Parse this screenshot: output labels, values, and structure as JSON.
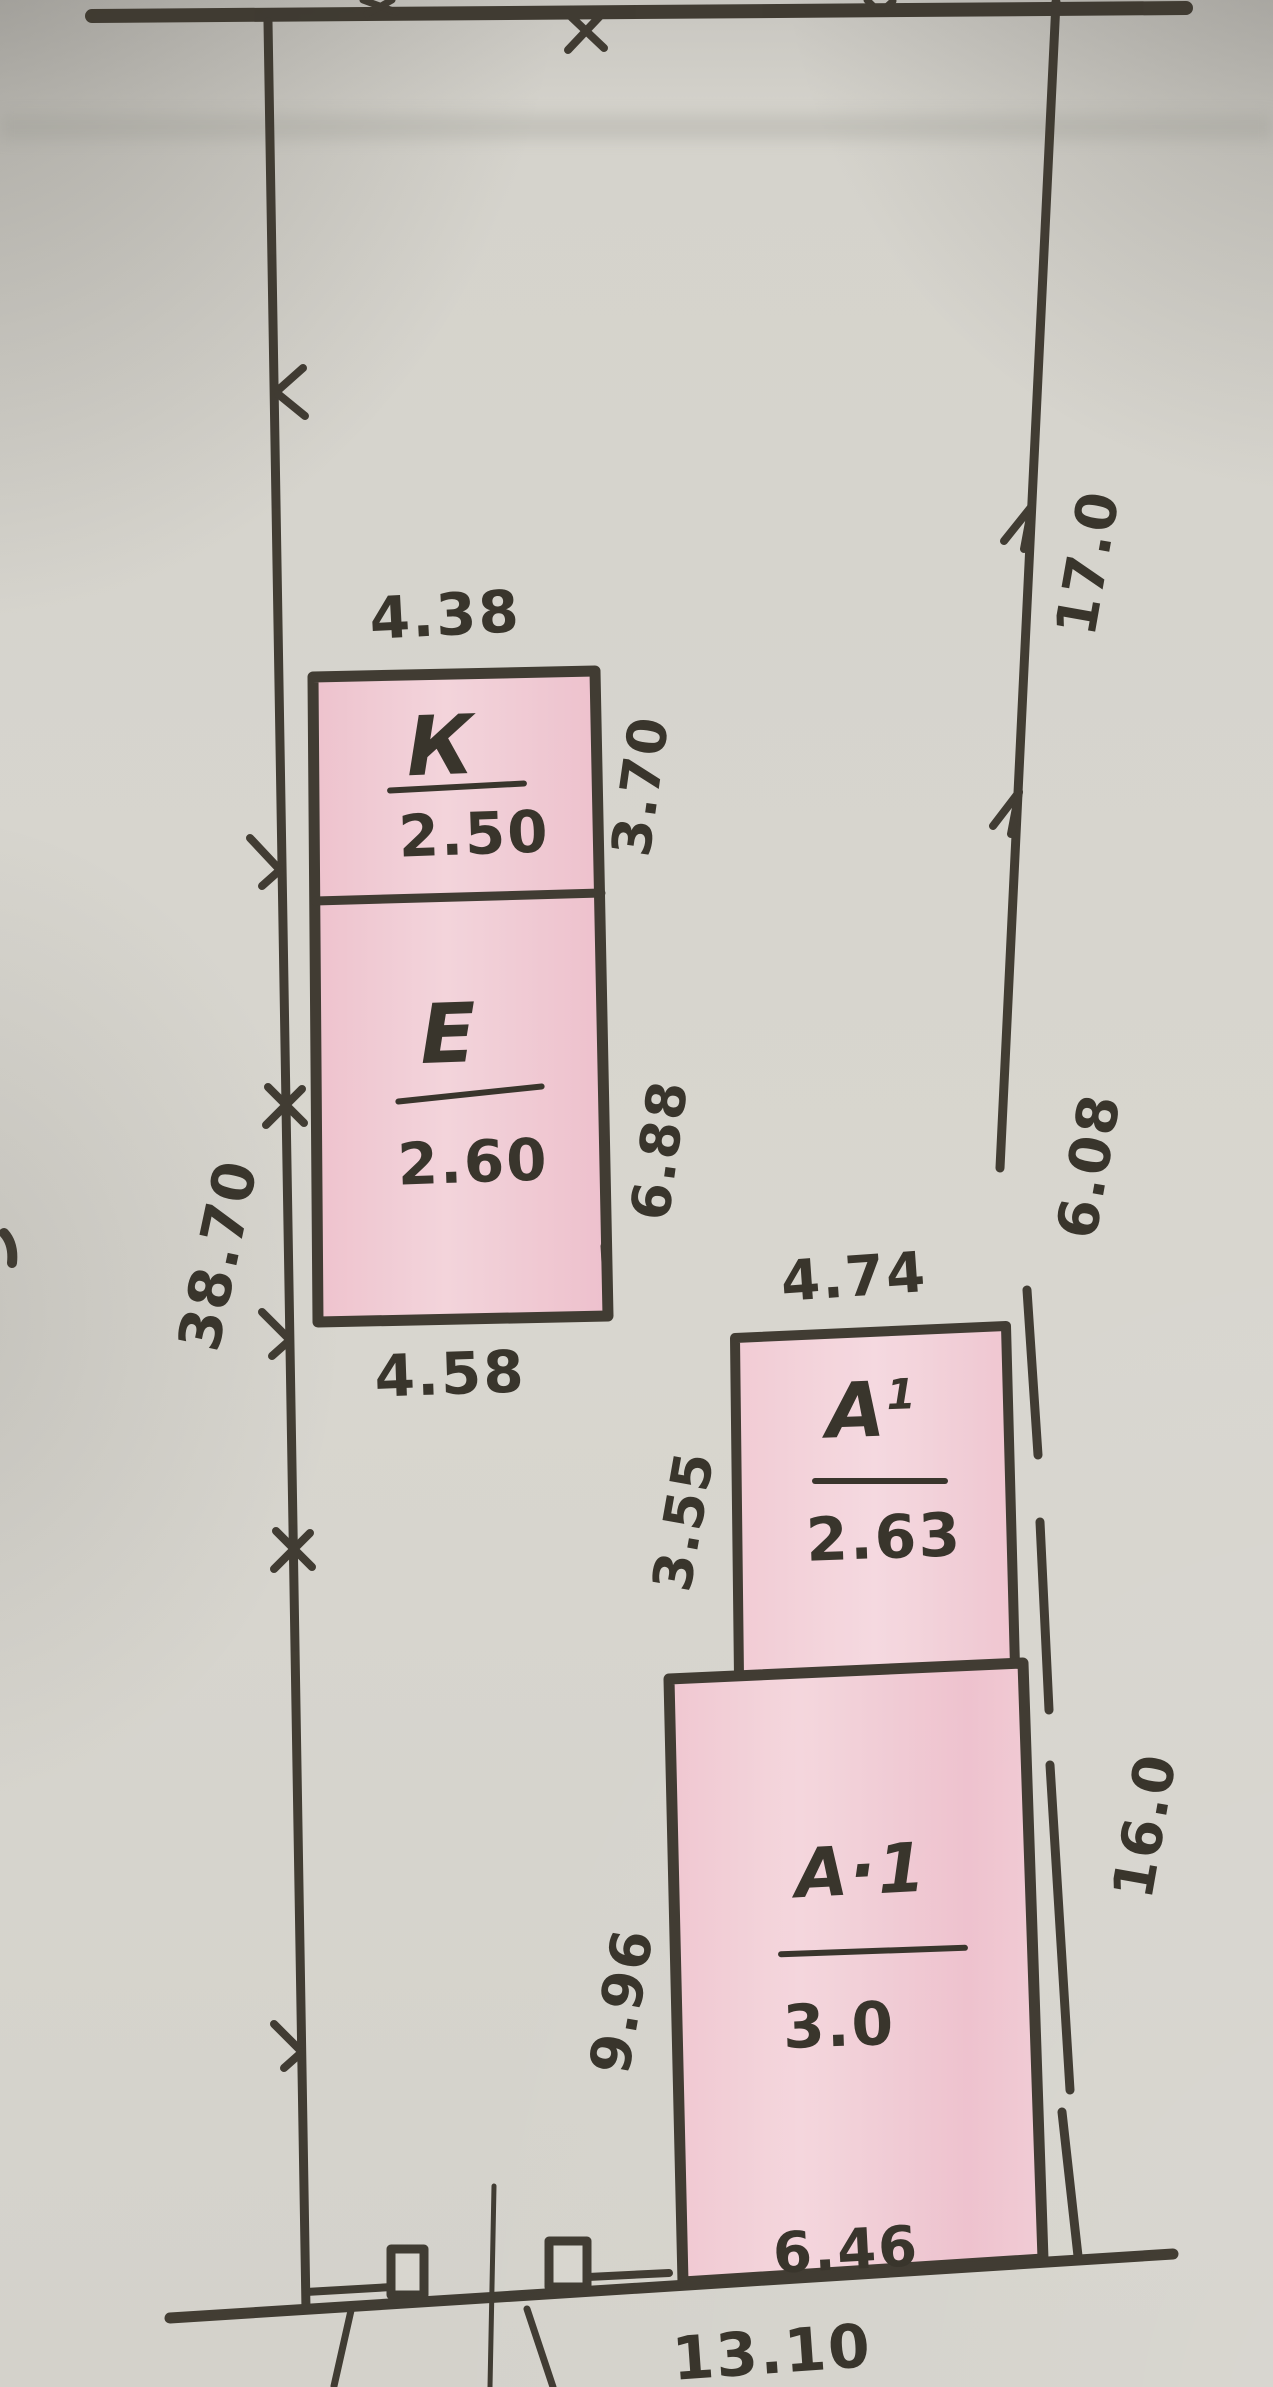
{
  "colors": {
    "paper": "#d7d5ce",
    "ink": "#3b362d",
    "building_fill_pink": "#f2c8d3"
  },
  "plan": {
    "boundary_dimensions": {
      "left": "38.70",
      "right_upper": "17.0",
      "right_middle": "6.08",
      "right_lower": "16.0",
      "bottom": "13.10"
    },
    "buildings": {
      "k": {
        "letter": "К",
        "value": "2.50",
        "width_top": "4.38",
        "depth_right": "3.70"
      },
      "e": {
        "letter": "Е",
        "value": "2.60",
        "depth_right": "6.88",
        "width_bottom": "4.58"
      },
      "a1_upper": {
        "letter": "А",
        "superscript": "1",
        "value": "2.63",
        "width_top": "4.74",
        "depth_left": "3.55"
      },
      "a1_lower": {
        "letter": "А·1",
        "value": "3.0",
        "depth_left": "9.96",
        "width_bottom": "6.46"
      }
    }
  }
}
